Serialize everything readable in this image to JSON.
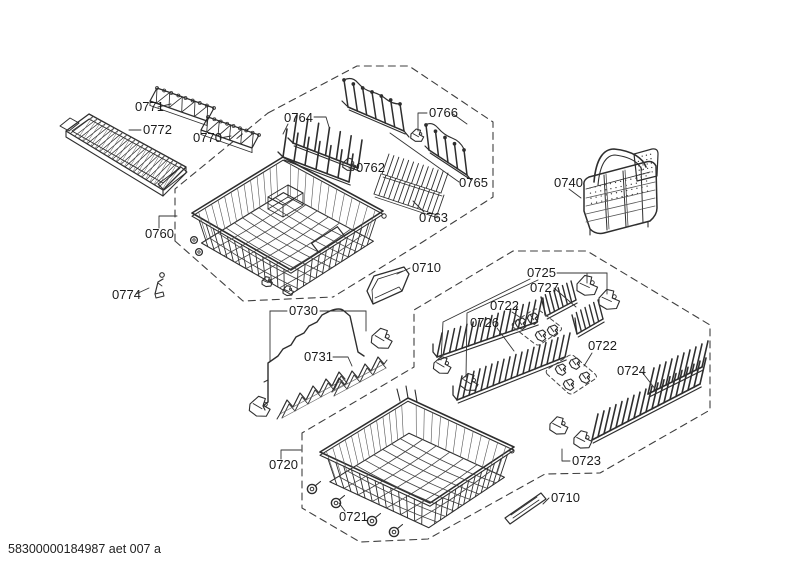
{
  "diagram": {
    "doc_code": "58300000184987 aet 007 a",
    "ink_color": "#2e2e2e",
    "background_color": "#ffffff",
    "callouts": [
      {
        "part": "0771"
      },
      {
        "part": "0772"
      },
      {
        "part": "0770"
      },
      {
        "part": "0764"
      },
      {
        "part": "0766"
      },
      {
        "part": "0762"
      },
      {
        "part": "0765"
      },
      {
        "part": "0763"
      },
      {
        "part": "0760"
      },
      {
        "part": "0774"
      },
      {
        "part": "0740"
      },
      {
        "part": "0710"
      },
      {
        "part": "0730"
      },
      {
        "part": "0731"
      },
      {
        "part": "0725"
      },
      {
        "part": "0727"
      },
      {
        "part": "0722"
      },
      {
        "part": "0726"
      },
      {
        "part": "0722"
      },
      {
        "part": "0724"
      },
      {
        "part": "0720"
      },
      {
        "part": "0721"
      },
      {
        "part": "0723"
      },
      {
        "part": "0710"
      }
    ]
  }
}
